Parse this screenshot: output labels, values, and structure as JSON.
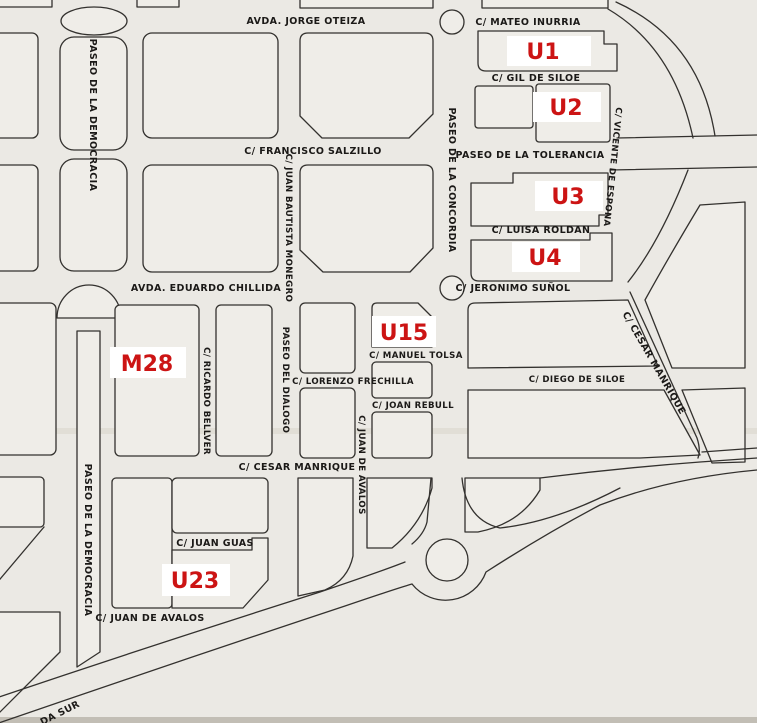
{
  "map": {
    "kind": "scanned black-and-white street map with red planning-zone labels",
    "colors": {
      "paper": "#ebe9e4",
      "line": "#33312e",
      "street_text": "#1b1917",
      "zone_text": "#cc1414",
      "zone_label_background": "#ffffff"
    },
    "zones": [
      {
        "id": "U1"
      },
      {
        "id": "U2"
      },
      {
        "id": "U3"
      },
      {
        "id": "U4"
      },
      {
        "id": "U15"
      },
      {
        "id": "M28"
      },
      {
        "id": "U23"
      }
    ],
    "streets": [
      {
        "name": "AVDA. JORGE OTEIZA",
        "orientation": "horizontal"
      },
      {
        "name": "C/ MATEO INURRIA",
        "orientation": "horizontal"
      },
      {
        "name": "C/ GIL DE SILOE",
        "orientation": "horizontal"
      },
      {
        "name": "C/ FRANCISCO SALZILLO",
        "orientation": "horizontal"
      },
      {
        "name": "PASEO DE LA TOLERANCIA",
        "orientation": "horizontal"
      },
      {
        "name": "C/ LUISA ROLDAN",
        "orientation": "horizontal"
      },
      {
        "name": "AVDA. EDUARDO CHILLIDA",
        "orientation": "horizontal"
      },
      {
        "name": "C/ JERONIMO SUÑOL",
        "orientation": "horizontal"
      },
      {
        "name": "C/ MANUEL TOLSA",
        "orientation": "horizontal"
      },
      {
        "name": "C/ LORENZO FRECHILLA",
        "orientation": "horizontal"
      },
      {
        "name": "C/ DIEGO DE SILOE",
        "orientation": "horizontal"
      },
      {
        "name": "C/ JOAN REBULL",
        "orientation": "horizontal"
      },
      {
        "name": "C/ CESAR MANRIQUE",
        "orientation": "horizontal"
      },
      {
        "name": "C/ JUAN GUAS",
        "orientation": "horizontal"
      },
      {
        "name": "C/ JUAN DE AVALOS",
        "orientation": "horizontal"
      },
      {
        "name": "PASEO DE LA DEMOCRACIA",
        "orientation": "vertical"
      },
      {
        "name": "C/ JUAN BAUTISTA MONEGRO",
        "orientation": "vertical"
      },
      {
        "name": "PASEO DE LA CONCORDIA",
        "orientation": "vertical"
      },
      {
        "name": "C/ VICENTE DE ESPONA",
        "orientation": "vertical"
      },
      {
        "name": "C/ RICARDO BELLVER",
        "orientation": "vertical"
      },
      {
        "name": "PASEO DEL DIALOGO",
        "orientation": "vertical"
      },
      {
        "name": "C/ JUAN DE AVALOS",
        "orientation": "vertical"
      },
      {
        "name": "C/ CESAR MANRIQUE",
        "orientation": "diagonal"
      },
      {
        "name": "PASEO DE LA DEMOCRACIA",
        "orientation": "vertical"
      },
      {
        "name": "DA SUR",
        "orientation": "diagonal-fragment"
      }
    ]
  }
}
